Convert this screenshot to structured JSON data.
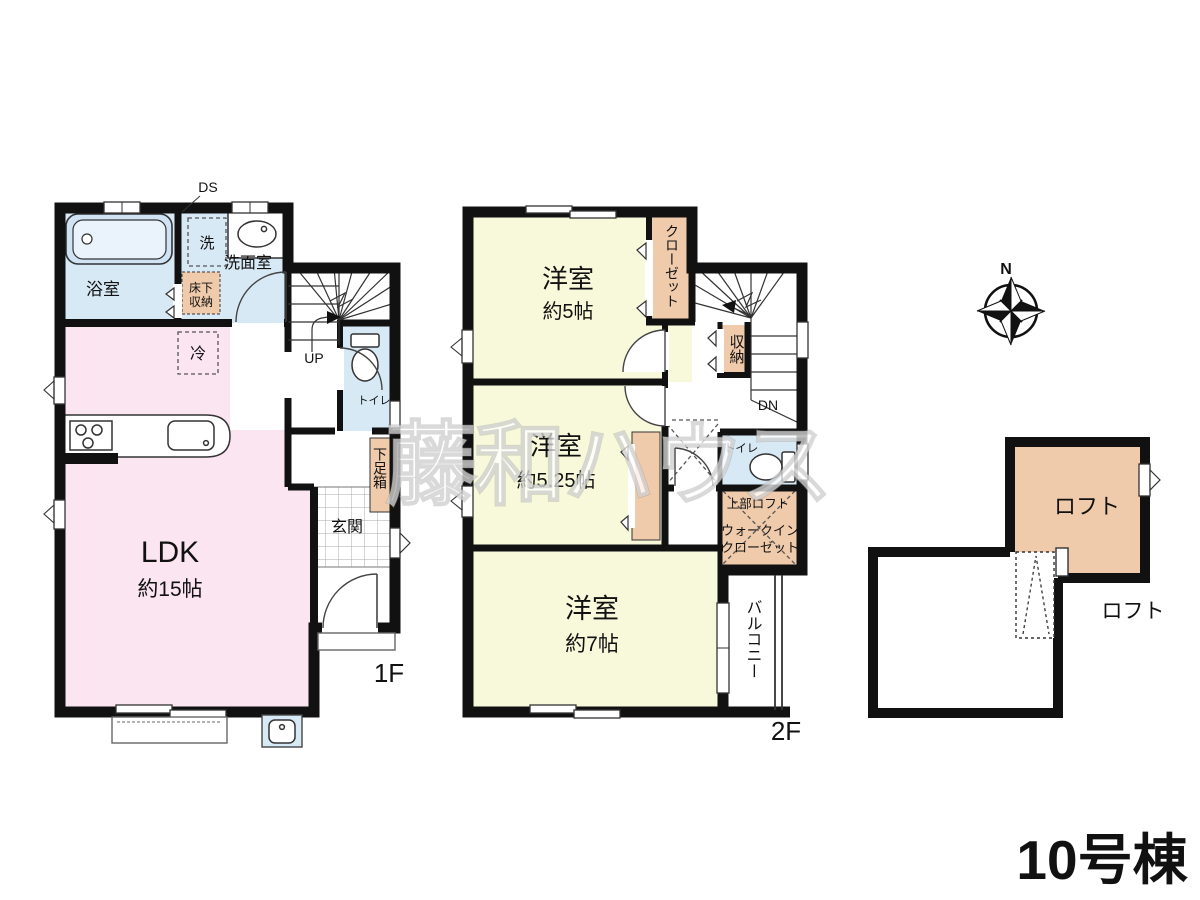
{
  "title": "10号棟",
  "watermark": "藤和ハウス",
  "compass": {
    "north": "N"
  },
  "colors": {
    "wall": "#111111",
    "navy": "#1c2a7a",
    "pink": "#fbe5f0",
    "yellow": "#f8f9da",
    "blue": "#d8e9f6",
    "orange": "#f0cbab"
  },
  "floor1": {
    "label": "1F",
    "bathroom": "浴室",
    "washroom": "洗面室",
    "washer": "洗",
    "duct": "DS",
    "underfloor1": "床下",
    "underfloor2": "収納",
    "fridge": "冷",
    "ldk": "LDK",
    "ldk_size": "約15帖",
    "up": "UP",
    "toilet": "トイレ",
    "shoebox": "下足箱",
    "entrance": "玄関"
  },
  "floor2": {
    "label": "2F",
    "bedroom1": "洋室",
    "bedroom1_size": "約5帖",
    "closet": "クローゼット",
    "storage": "収納",
    "down": "DN",
    "bedroom2": "洋室",
    "bedroom2_size": "約5.25帖",
    "toilet": "トイレ",
    "upper_loft": "上部ロフト",
    "wic1": "ウォークイン",
    "wic2": "クローゼット",
    "bedroom3": "洋室",
    "bedroom3_size": "約7帖",
    "balcony": "バルコニー"
  },
  "loft": {
    "room": "ロフト",
    "label": "ロフト"
  }
}
